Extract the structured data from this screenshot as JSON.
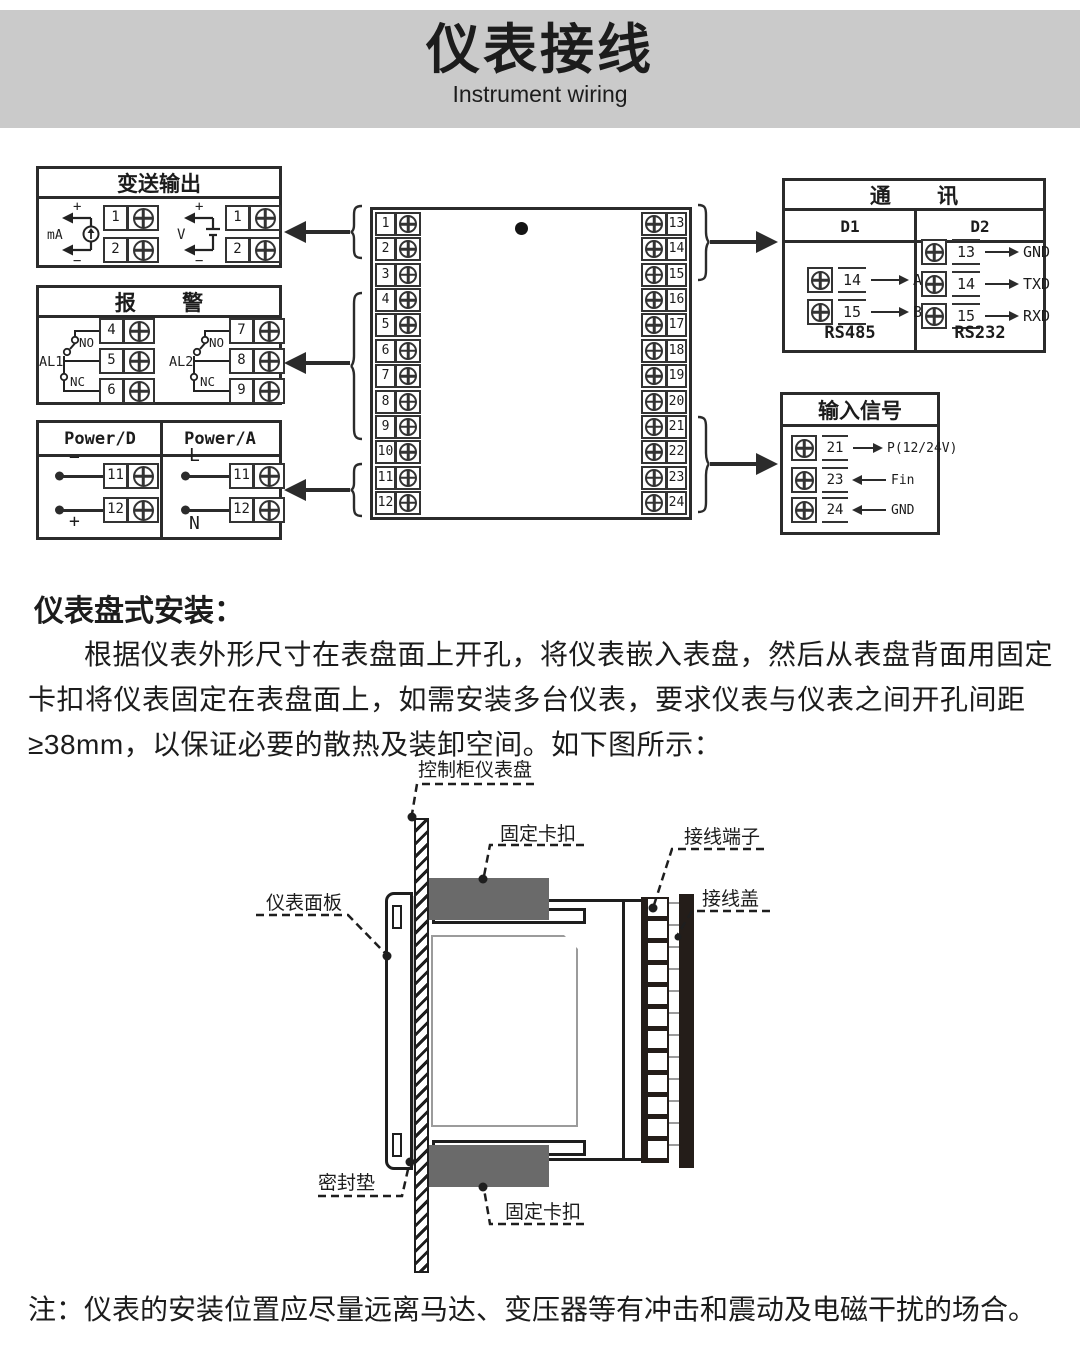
{
  "header": {
    "title": "仪表接线",
    "subtitle": "Instrument wiring"
  },
  "colors": {
    "banner": "#cacaca",
    "ink": "#2b2b2b",
    "clip_gray": "#6a6a6a",
    "gasket_gray": "#c6c6c6"
  },
  "wiring": {
    "transmit": {
      "title": "变送输出",
      "ma": {
        "label": "mA",
        "plus": "+",
        "minus": "−",
        "terminals": [
          "1",
          "2"
        ]
      },
      "v": {
        "label": "V",
        "plus": "+",
        "minus": "−",
        "terminals": [
          "1",
          "2"
        ]
      }
    },
    "alarm": {
      "title": "报警",
      "al1": {
        "name": "AL1",
        "no": "NO",
        "nc": "NC",
        "terminals": [
          "4",
          "5",
          "6"
        ]
      },
      "al2": {
        "name": "AL2",
        "no": "NO",
        "nc": "NC",
        "terminals": [
          "7",
          "8",
          "9"
        ]
      }
    },
    "power": {
      "d_header": "Power/D",
      "a_header": "Power/A",
      "d": {
        "top": "−",
        "bottom": "+",
        "terminals": [
          "11",
          "12"
        ]
      },
      "a": {
        "top": "L",
        "bottom": "N",
        "terminals": [
          "11",
          "12"
        ]
      }
    },
    "center": {
      "left": [
        "1",
        "2",
        "3",
        "4",
        "5",
        "6",
        "7",
        "8",
        "9",
        "10",
        "11",
        "12"
      ],
      "right": [
        "13",
        "14",
        "15",
        "16",
        "17",
        "18",
        "19",
        "20",
        "21",
        "22",
        "23",
        "24"
      ]
    },
    "comm": {
      "title": "通讯",
      "d1": {
        "header": "D1",
        "rows": [
          {
            "num": "14",
            "label": "A"
          },
          {
            "num": "15",
            "label": "B"
          }
        ],
        "caption": "RS485"
      },
      "d2": {
        "header": "D2",
        "rows": [
          {
            "num": "13",
            "label": "GND"
          },
          {
            "num": "14",
            "label": "TXD"
          },
          {
            "num": "15",
            "label": "RXD"
          }
        ],
        "caption": "RS232"
      }
    },
    "input": {
      "title": "输入信号",
      "rows": [
        {
          "num": "21",
          "label": "P(12/24V)"
        },
        {
          "num": "23",
          "label": "Fin"
        },
        {
          "num": "24",
          "label": "GND"
        }
      ]
    }
  },
  "install": {
    "heading": "仪表盘式安装：",
    "paragraph": "根据仪表外形尺寸在表盘面上开孔，将仪表嵌入表盘，然后从表盘背面用固定卡扣将仪表固定在表盘面上，如需安装多台仪表，要求仪表与仪表之间开孔间距≥38mm，以保证必要的散热及装卸空间。如下图所示：",
    "labels": {
      "cabinet_panel": "控制柜仪表盘",
      "clip_top": "固定卡扣",
      "terminal_block": "接线端子",
      "wiring_cover": "接线盖",
      "faceplate": "仪表面板",
      "gasket": "密封垫",
      "clip_bottom": "固定卡扣"
    }
  },
  "note": "注：仪表的安装位置应尽量远离马达、变压器等有冲击和震动及电磁干扰的场合。"
}
